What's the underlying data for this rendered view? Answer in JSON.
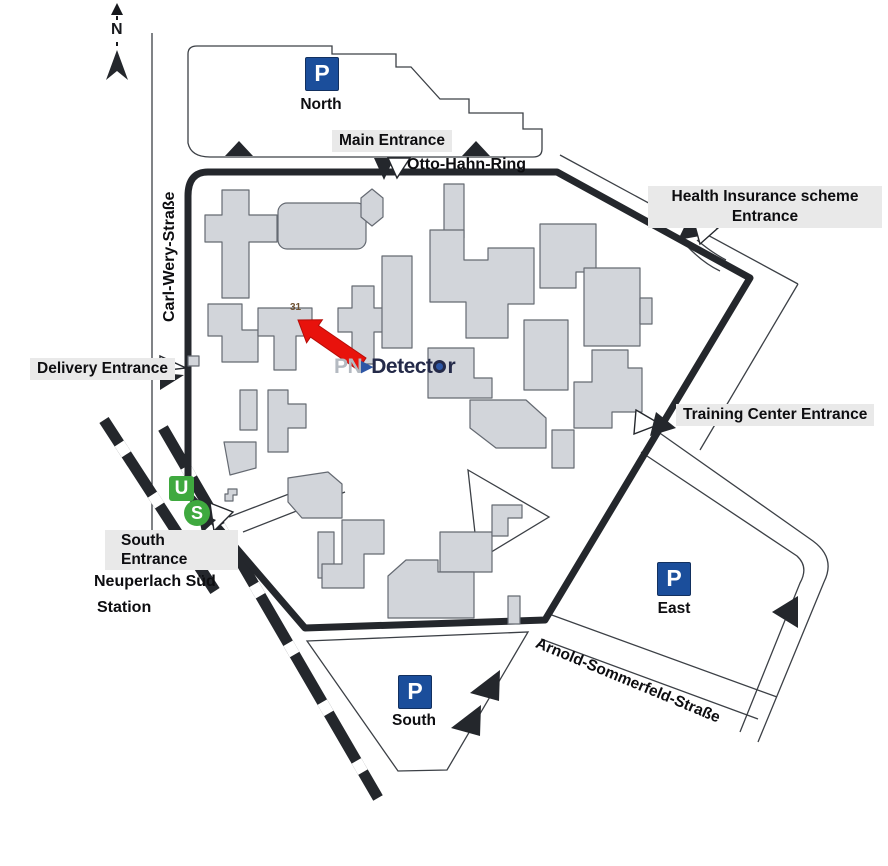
{
  "map": {
    "compass": {
      "label": "N"
    },
    "streets": {
      "carl_wery": "Carl-Wery-Straße",
      "otto_hahn": "Otto-Hahn-Ring",
      "arnold": "Arnold-Sommerfeld-Straße"
    },
    "entrances": {
      "main": "Main Entrance",
      "health_line1": "Health Insurance scheme",
      "health_line2": "Entrance",
      "training": "Training Center Entrance",
      "delivery": "Delivery Entrance",
      "south_line1": "South",
      "south_line2": "Entrance"
    },
    "station": {
      "line1": "Neuperlach Süd",
      "line2": "Station",
      "u_symbol": "U",
      "s_symbol": "S"
    },
    "parking": {
      "symbol": "P",
      "north": "North",
      "east": "East",
      "south": "South"
    },
    "building_number": "31",
    "logo": {
      "pn": "PN",
      "triangle": "▶",
      "detect": "Detect",
      "r": "r"
    },
    "colors": {
      "parking_blue": "#1b4e9b",
      "transit_green": "#3fa93f",
      "arrow_red": "#e8120c",
      "building_fill": "#d2d5da",
      "building_stroke": "#656a72",
      "boundary": "#24272c",
      "label_bg": "#e9e9e9"
    }
  }
}
